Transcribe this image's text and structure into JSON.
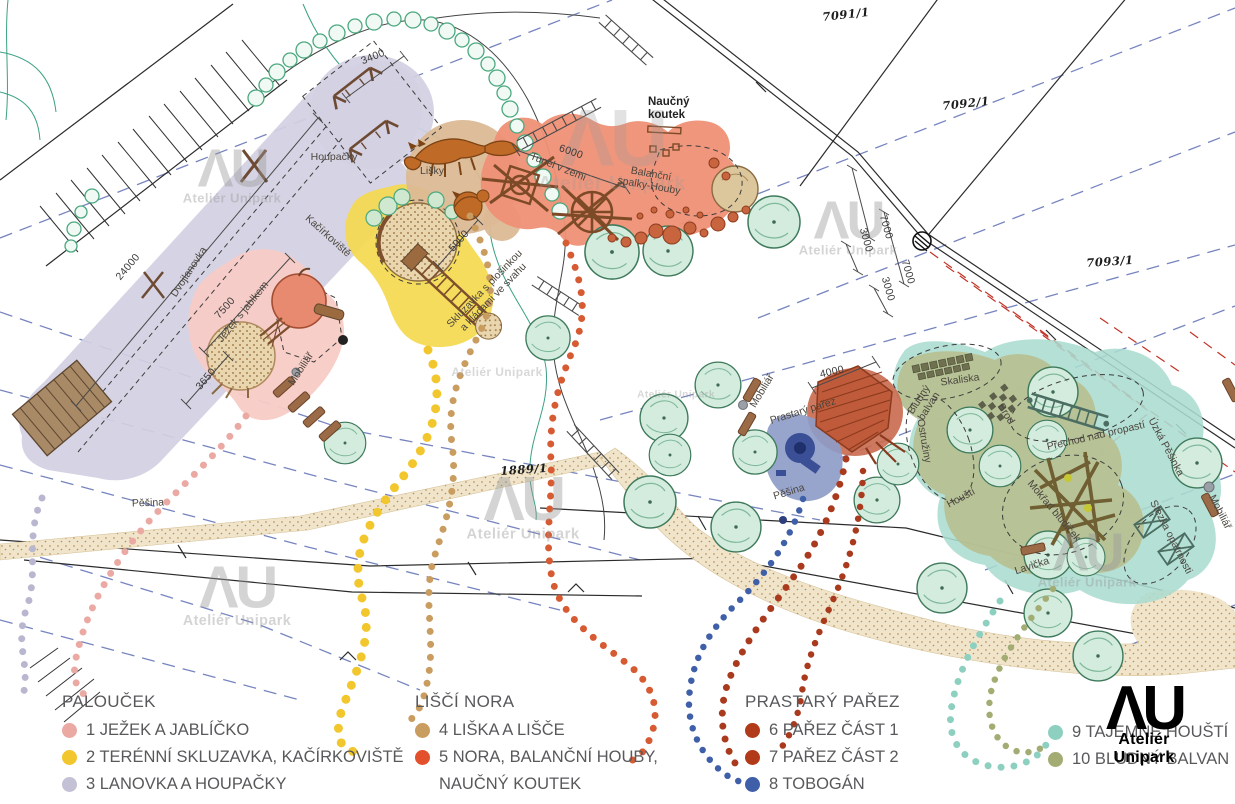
{
  "legend": {
    "groups": [
      {
        "header": "PALOUČEK",
        "items": [
          {
            "label": "1 JEŽEK A JABLÍČKO",
            "color": "#eba9a3"
          },
          {
            "label": "2 TERÉNNÍ SKLUZAVKA, KAČÍRKOVIŠTĚ",
            "color": "#f2c72e"
          },
          {
            "label": "3 LANOVKA A HOUPAČKY",
            "color": "#c2c1d6"
          }
        ]
      },
      {
        "header": "LIŠČÍ NORA",
        "items": [
          {
            "label": "4 LIŠKA A LIŠČE",
            "color": "#c99c5f"
          },
          {
            "label": "5 NORA, BALANČNÍ HOUBY,",
            "label2": "NAUČNÝ KOUTEK",
            "color": "#e2512c"
          }
        ]
      },
      {
        "header": "PRASTARÝ PAŘEZ",
        "items": [
          {
            "label": "6 PAŘEZ ČÁST 1",
            "color": "#b13a19"
          },
          {
            "label": "7 PAŘEZ ČÁST 2",
            "color": "#b13a19"
          },
          {
            "label": "8 TOBOGÁN",
            "color": "#3f5fa8"
          }
        ]
      },
      {
        "header": "",
        "items": [
          {
            "label": "9 TAJEMNÉ HOUŠTÍ",
            "color": "#8ed0c0"
          },
          {
            "label": "10 BLUDNÝ BALVAN",
            "color": "#a3ad73"
          }
        ]
      }
    ]
  },
  "logo": {
    "mark": "ΛU",
    "name": "Ateliér Unipark"
  },
  "watermark": {
    "mark": "ΛU",
    "name": "Ateliér Unipark"
  },
  "map": {
    "labels": {
      "houpacky": "Houpačky",
      "dvojlanovka": "Dvojlanovka",
      "lisky": "Lišky",
      "kacirkoviste": "Kačírkoviště",
      "jezek": "Ježek s jablkem",
      "mobiliar1": "Mobiliář",
      "naucny1": "Naučný",
      "naucny2": "koutek",
      "tunel": "Tunel v zemi",
      "balancni1": "Balanční",
      "balancni2": "spalky-Houby",
      "skluzavka1": "Skluzavka s plošinkou",
      "skluzavka2": "a kládami ve svahu",
      "pesina1": "Pěšina",
      "pesina2": "Pěšina",
      "mobiliar2": "Mobiliář",
      "mobiliar3": "Mobiliář",
      "prastary": "Prastarý pařez",
      "bludny1": "Bludný",
      "bludny2": "balvan",
      "skaliska": "Skaliska",
      "brod": "Brod",
      "ostruziny": "Ostružiny",
      "housti": "Houští",
      "prechod": "Přechod nad propastí",
      "uzka": "Úzká Pěšinka",
      "mokrad": "Mokřad bludiček",
      "stezka": "Stezka opatrnosti",
      "lavicka": "Lavička"
    },
    "parcels": {
      "p1": "7091/1",
      "p2": "7092/1",
      "p3": "7093/1",
      "p4": "1889/1"
    },
    "dimensions": {
      "d3400": "3400",
      "d24000": "24000",
      "d7500": "7500",
      "d3650": "3650",
      "d5000": "5000",
      "d6000": "6000",
      "d4000": "4000",
      "d7000a": "7000",
      "d3000a": "3000",
      "d7000b": "7000",
      "d3000b": "3000"
    }
  }
}
